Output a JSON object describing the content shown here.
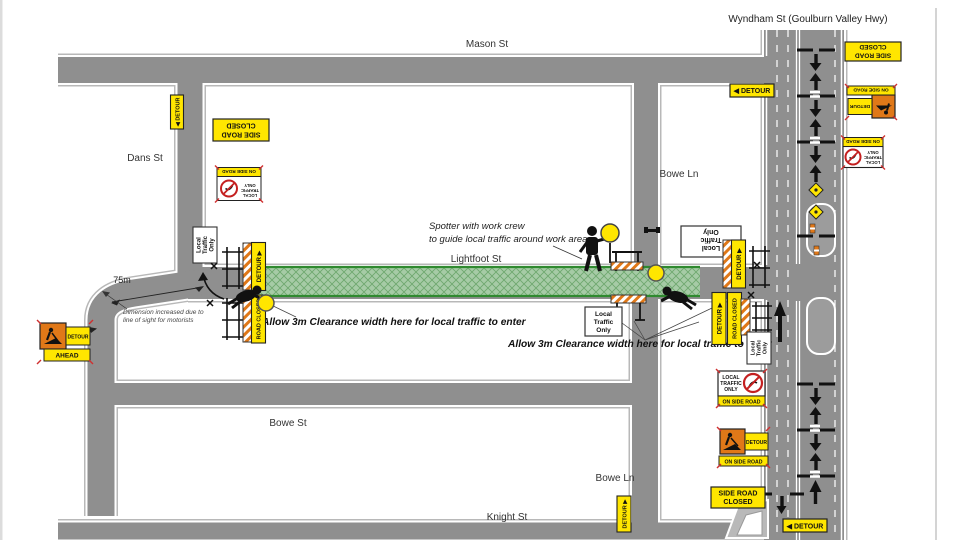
{
  "page": {
    "title": "Wyndham St (Goulburn Valley Hwy)"
  },
  "streets": {
    "mason": "Mason St",
    "dans": "Dans St",
    "bowe_ln_north": "Bowe Ln",
    "lightfoot": "Lightfoot St",
    "bowe_st": "Bowe St",
    "bowe_ln_south": "Bowe Ln",
    "knight": "Knight St"
  },
  "notes": {
    "spotter_line1": "Spotter with work crew",
    "spotter_line2": "to guide local traffic around work area",
    "clearance_left": "Allow 3m Clearance width here for local traffic to enter",
    "clearance_right": "Allow 3m Clearance width here for local traffic to enter",
    "dimension": "75m",
    "dim_note_line1": "Dimension increased due to",
    "dim_note_line2": "line of sight for motorists"
  },
  "signs": {
    "detour": "DETOUR",
    "detour_arrow_left": "◀ DETOUR",
    "detour_arrow_up": "DETOUR ▶",
    "road_closed": "ROAD CLOSED",
    "side_road": "SIDE ROAD",
    "closed": "CLOSED",
    "on_side_road": "ON SIDE ROAD",
    "ahead": "AHEAD",
    "local_caps": [
      "LOCAL",
      "TRAFFIC",
      "ONLY"
    ],
    "local_mixed": [
      "Local",
      "Traffic",
      "Only"
    ]
  },
  "colors": {
    "road": "#8f8f8f",
    "work_area_green": "#a6cba6",
    "work_area_edge": "#2f8a2f",
    "sign_yellow": "#ffe600",
    "work_orange": "#e07818",
    "prohibition_red": "#c42020"
  }
}
